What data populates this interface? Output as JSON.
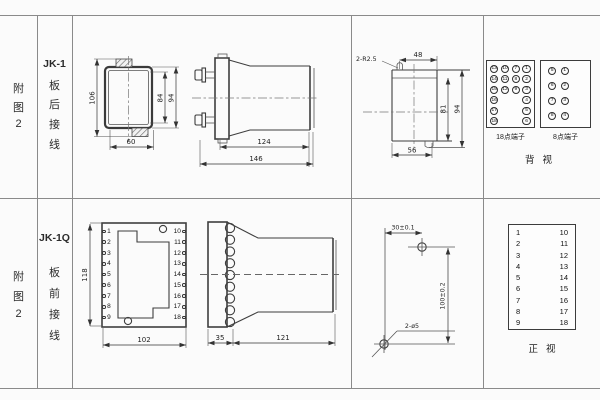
{
  "common": {
    "figure_label_chars": [
      "附",
      "图",
      "2"
    ]
  },
  "top": {
    "model": "JK-1",
    "wiring_chars": [
      "板",
      "后",
      "接",
      "线"
    ],
    "front_view_dims": {
      "overall_height": "106",
      "inner_height": "84",
      "outer_height": "94",
      "width": "60"
    },
    "side_view_dims": {
      "body_length": "124",
      "overall_length": "146"
    },
    "cutout_dims": {
      "corner_note": "2-R2.5",
      "top_width": "48",
      "inner_height": "81",
      "overall_height": "94",
      "bottom_width": "56"
    },
    "terminal18": {
      "label": "18点端子",
      "grid": [
        [
          "13",
          "10",
          "7",
          "1"
        ],
        [
          "14",
          "11",
          "8",
          "2"
        ],
        [
          "15",
          "12",
          "9",
          "3"
        ],
        [
          "16",
          "",
          "",
          "4"
        ],
        [
          "17",
          "",
          "",
          "5"
        ],
        [
          "18",
          "",
          "",
          "6"
        ]
      ]
    },
    "terminal8": {
      "label": "8点端子",
      "grid": [
        [
          "5",
          "1"
        ],
        [
          "6",
          "2"
        ],
        [
          "7",
          "3"
        ],
        [
          "8",
          "4"
        ]
      ]
    },
    "view_label": "背视"
  },
  "bottom": {
    "model": "JK-1Q",
    "wiring_chars": [
      "板",
      "前",
      "接",
      "线"
    ],
    "front_view": {
      "left_terminals": [
        "1",
        "2",
        "3",
        "4",
        "5",
        "6",
        "7",
        "8",
        "9"
      ],
      "right_terminals": [
        "10",
        "11",
        "12",
        "13",
        "14",
        "15",
        "16",
        "17",
        "18"
      ],
      "dims": {
        "height": "118",
        "width": "102"
      }
    },
    "side_view_dims": {
      "flange_depth": "35",
      "body_length": "121"
    },
    "drill_dims": {
      "horizontal": "30±0.1",
      "vertical": "100±0.2",
      "holes": "2-ø5"
    },
    "terminal_table": {
      "left": [
        "1",
        "2",
        "3",
        "4",
        "5",
        "6",
        "7",
        "8",
        "9"
      ],
      "right": [
        "10",
        "11",
        "12",
        "13",
        "14",
        "15",
        "16",
        "17",
        "18"
      ]
    },
    "view_label": "正视"
  }
}
